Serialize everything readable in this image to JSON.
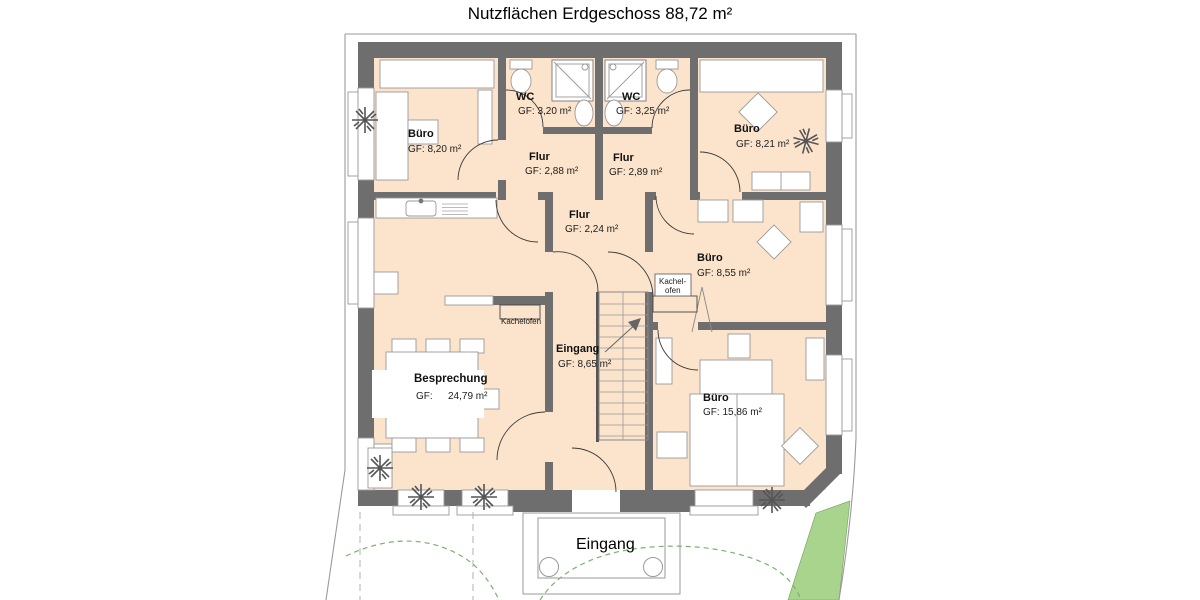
{
  "title": "Nutzflächen Erdgeschoss 88,72 m²",
  "colors": {
    "wall": "#6e6e6e",
    "floor": "#fbe4cb",
    "green_area": "#a9d48d",
    "green_line": "#7cb06e",
    "boundary": "#9a9a9a"
  },
  "rooms": {
    "buero_top_left": {
      "name": "Büro",
      "area": "GF: 8,20 m²"
    },
    "wc_left": {
      "name": "WC",
      "area": "GF: 3,20 m²"
    },
    "wc_right": {
      "name": "WC",
      "area": "GF: 3,25 m²"
    },
    "buero_top_right": {
      "name": "Büro",
      "area": "GF: 8,21 m²"
    },
    "flur_left": {
      "name": "Flur",
      "area": "GF: 2,88 m²"
    },
    "flur_right": {
      "name": "Flur",
      "area": "GF: 2,89 m²"
    },
    "flur_middle": {
      "name": "Flur",
      "area": "GF: 2,24 m²"
    },
    "buero_middle": {
      "name": "Büro",
      "area": "GF: 8,55 m²"
    },
    "besprechung": {
      "name": "Besprechung",
      "area_label": "GF:",
      "area_value": "24,79 m²"
    },
    "eingang_hall": {
      "name": "Eingang",
      "area": "GF: 8,65 m²"
    },
    "buero_bottom_right": {
      "name": "Büro",
      "area": "GF: 15,86 m²"
    }
  },
  "annotations": {
    "kachelofen_stacked_line1": "Kachel-",
    "kachelofen_stacked_line2": "ofen",
    "kachelofen_inline": "Kachelofen",
    "entrance_porch": "Eingang"
  }
}
